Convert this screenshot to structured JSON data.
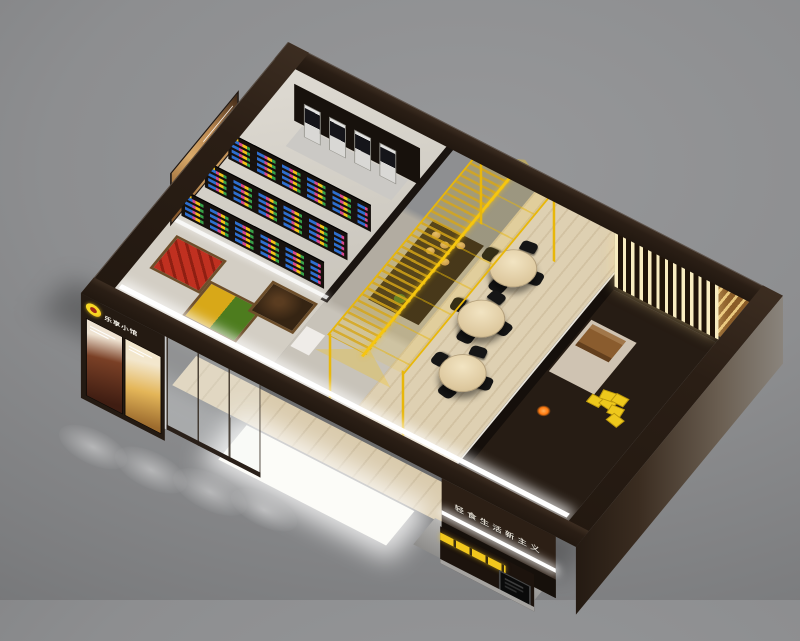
{
  "scene": {
    "type": "3d-isometric-interior-render",
    "description": "Bird's-eye cutaway render of a branded retail cafe / light-food shop with dark brown walls and yellow accents",
    "background_color": "#8d8e90",
    "wall_color": "#2a1e15",
    "accent_yellow": "#f2c71d"
  },
  "branding": {
    "logo_badge": "round yellow-orange emblem",
    "logo_text": "乐享小馆",
    "fascia_sign_text": "轻食生活新主义",
    "poster_captions": [
      "新品推荐",
      "招牌美味"
    ]
  },
  "storefront": {
    "pier_posters": [
      {
        "name": "drink-poster",
        "tone": "#7a4026"
      },
      {
        "name": "food-poster",
        "tone": "#e4b659"
      }
    ],
    "window": "glass display window with wood-framed produce bins behind",
    "led_strip_color": "#ffffff",
    "ground_glow": "large white light reflection on pavement",
    "kiosk": {
      "body_color": "#1c130d",
      "band_color": "#f2c71d",
      "screen": "black self-order screen",
      "base_color": "#a5a3a0"
    }
  },
  "zones": {
    "retail_room": {
      "floor": "#d6d2ca",
      "vending_machines": 4,
      "machine_style": "slim silver towers with black screens",
      "shelf_gondolas": 3,
      "product_colors": [
        "#2e6fd0",
        "#d8488f",
        "#f2c218",
        "#37a148"
      ],
      "wall_poster": "lightbox photo of person in yellow shirt",
      "produce_bins": 3,
      "bin_contents_colors": [
        "#c03020",
        "#d8a818",
        "#4d7c1e",
        "#3a2a18"
      ]
    },
    "canopy": {
      "shape": "gabled greenhouse-style wireframe",
      "frame_color": "#e8b70a",
      "panels": "translucent yellow with louvered slats",
      "contents": "dark display counter with pastries and a plant"
    },
    "dining": {
      "floor": "light wood plank #ded0b2",
      "tables": 3,
      "chairs_per_table": 4,
      "table_color": "#e6d6b4",
      "chair_color": "#161616"
    },
    "slat_room": {
      "style": "back-lit vertical wood slat screen",
      "slat_light_color": "#f8ecc0",
      "slat_dark_color": "#201409"
    },
    "service_area": {
      "floor": "#261c14",
      "counter": "beige L-shaped counter",
      "crate": "wooden crate",
      "yellow_boxes": 6,
      "warm_light_dot": "#ff7a10"
    }
  }
}
